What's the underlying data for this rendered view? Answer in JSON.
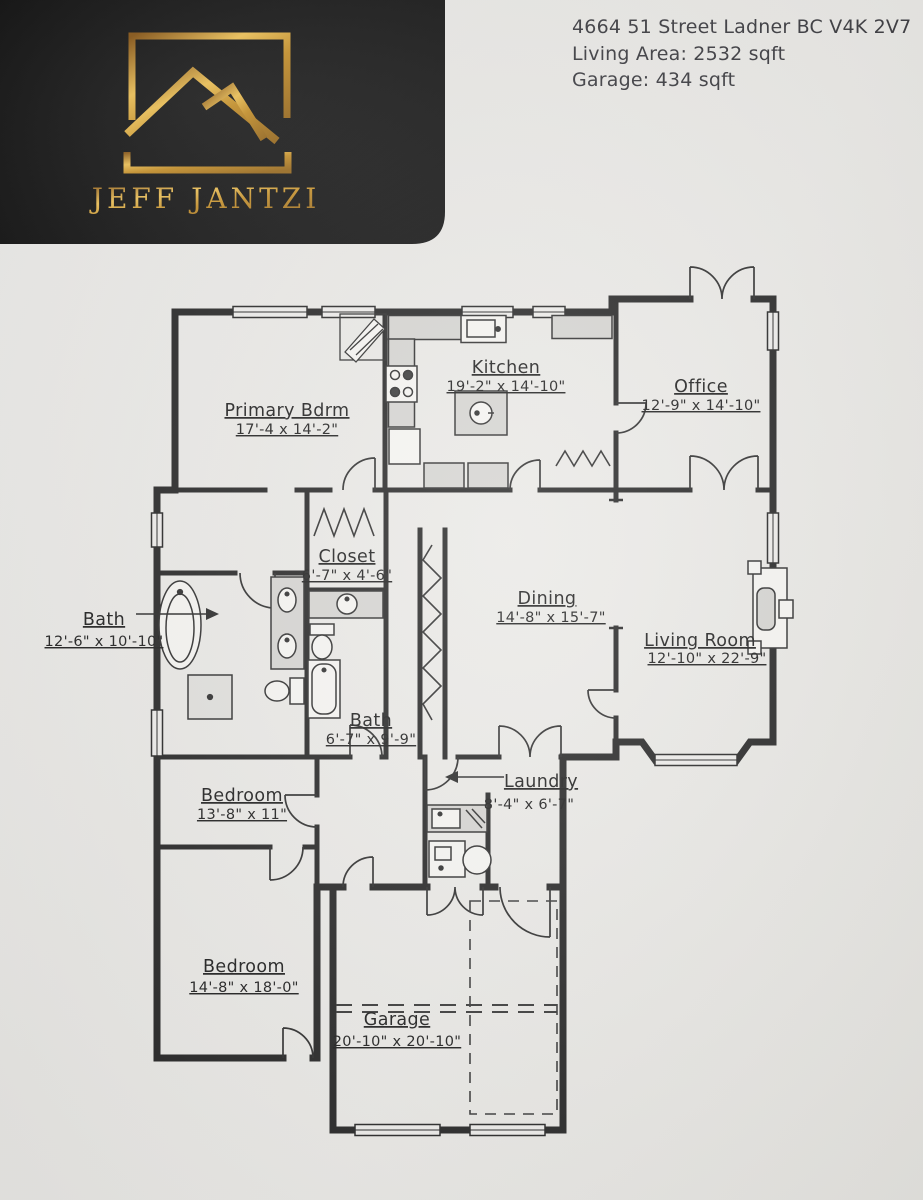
{
  "header": {
    "address": "4664 51 Street Ladner BC V4K 2V7",
    "living_area": "Living Area: 2532 sqft",
    "garage_area": "Garage: 434 sqft"
  },
  "logo": {
    "brand": "JEFF JANTZI",
    "icon": "gold-roof-peaks-in-frame",
    "colors": {
      "background": "#171717",
      "gold": "#cf9a3c"
    }
  },
  "floor_plan": {
    "style": {
      "wall_color": "#272727",
      "paper_color": "#e9e8e5",
      "counter_fill": "#d5d4d1",
      "fixture_fill": "#f5f4f1"
    },
    "rooms": [
      {
        "name": "Kitchen",
        "dims": "19'-2\" x 14'-10\""
      },
      {
        "name": "Office",
        "dims": "12'-9\" x 14'-10\""
      },
      {
        "name": "Primary Bdrm",
        "dims": "17'-4 x 14'-2\""
      },
      {
        "name": "Closet",
        "dims": "6'-7\" x 4'-6\""
      },
      {
        "name": "Bath",
        "dims": "12'-6\" x 10'-10\"",
        "pointer": "arrow-right"
      },
      {
        "name": "Dining",
        "dims": "14'-8\" x 15'-7\""
      },
      {
        "name": "Living Room",
        "dims": "12'-10\" x 22'-9\""
      },
      {
        "name": "Bath",
        "dims": "6'-7\" x 9'-9\""
      },
      {
        "name": "Laundry",
        "dims": "8'-4\" x 6'-7\"",
        "pointer": "arrow-left"
      },
      {
        "name": "Bedroom",
        "dims": "13'-8\" x 11\""
      },
      {
        "name": "Bedroom",
        "dims": "14'-8\" x 18'-0\""
      },
      {
        "name": "Garage",
        "dims": "20'-10\" x 20'-10\""
      }
    ],
    "fixtures": [
      "oval-bathtub",
      "double-vanity-sinks",
      "shower-stall",
      "toilet",
      "vanity-sink",
      "toilet",
      "bathtub",
      "kitchen-sink",
      "range-stove",
      "refrigerator",
      "island-sink",
      "corner-cabinet",
      "laundry-sink",
      "furnace",
      "hot-water-tank",
      "fireplace",
      "closet-rod-zigzag",
      "pantry-zigzag",
      "linen-zigzag"
    ]
  }
}
